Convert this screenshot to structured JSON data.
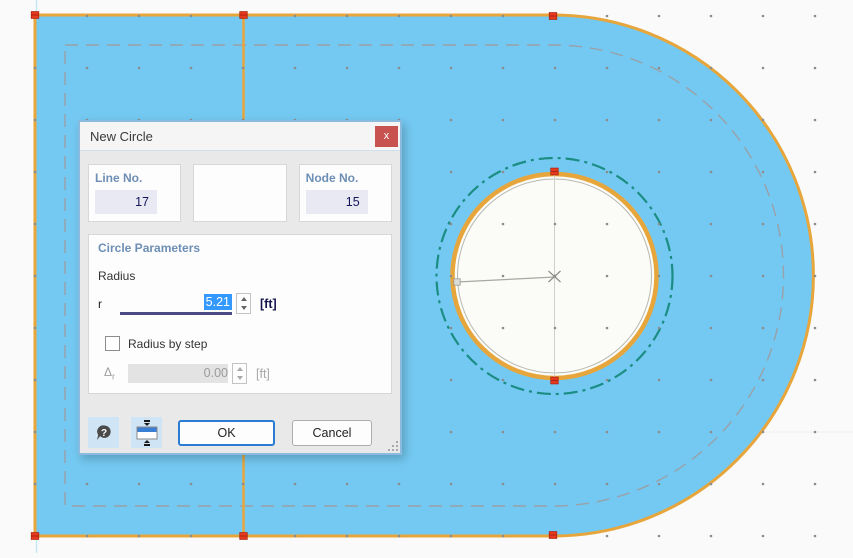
{
  "dialog": {
    "title": "New Circle",
    "close_label": "x",
    "line_no": {
      "label": "Line No.",
      "value": "17"
    },
    "node_no": {
      "label": "Node No.",
      "value": "15"
    },
    "params": {
      "title": "Circle Parameters",
      "radius_label": "Radius",
      "r_label": "r",
      "r_value": "5.21",
      "r_unit": "[ft]",
      "step_label": "Radius by step",
      "delta_symbol": "Δ",
      "delta_sub": "r",
      "delta_value": "0.00",
      "delta_unit": "[ft]"
    },
    "buttons": {
      "ok": "OK",
      "cancel": "Cancel"
    }
  },
  "canvas": {
    "colors": {
      "background": "#fafafa",
      "surface_fill": "#74c9f2",
      "outline": "#e7a63c",
      "dashed_offset": "#9aa0a8",
      "teal_guide": "#1b8d83",
      "opening_fill": "#fbfbf8",
      "thin_circle": "#b8b8b2",
      "construction": "#a8a8a2",
      "dot": "#8c8c8c",
      "handle": "#e8391f",
      "handle_dark": "#aa2410",
      "axis_line": "#c5e9f4",
      "faint_line": "#ededed"
    },
    "shape": {
      "left": 35,
      "top": 15,
      "right_flat": 553,
      "bottom": 536,
      "arc_r": 260.5,
      "inset": 30
    },
    "divider_x": 243.5,
    "circle": {
      "cx": 554.5,
      "cy": 276,
      "teal_r": 118,
      "ring_r": 102,
      "ring_w": 4.5,
      "inner_r": 97
    },
    "radius_line": {
      "x1": 555,
      "y1": 277,
      "x2": 457,
      "y2": 282
    },
    "grid": {
      "x0": 35,
      "y0": 16,
      "step": 52,
      "cols": 16,
      "rows": 11
    },
    "handles": [
      [
        35,
        15
      ],
      [
        243.5,
        15
      ],
      [
        553,
        16
      ],
      [
        35,
        536
      ],
      [
        243.5,
        536
      ],
      [
        553,
        535
      ],
      [
        554.5,
        171.5
      ],
      [
        554.5,
        380.5
      ]
    ]
  }
}
